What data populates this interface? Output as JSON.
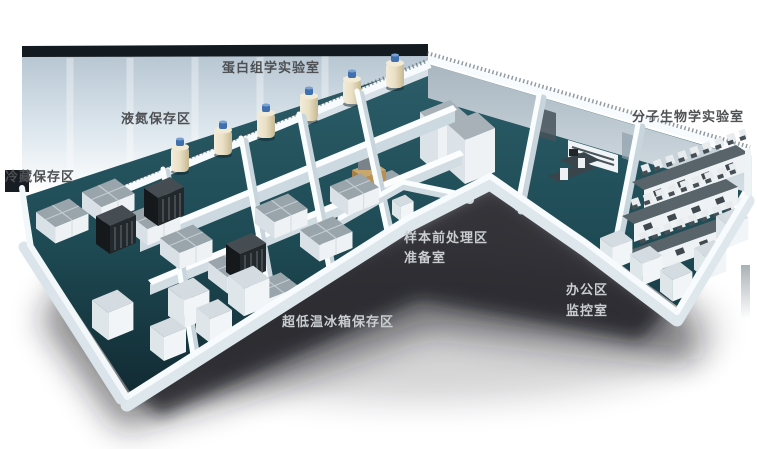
{
  "canvas": {
    "width": 757,
    "height": 449,
    "background": "#ffffff"
  },
  "labels": {
    "proteomics_lab": "蛋白组学实验室",
    "liquid_nitrogen_area": "液氮保存区",
    "cold_storage_area": "冷藏保存区",
    "molecular_biology_lab": "分子生物学实验室",
    "sample_pretreatment_area": "样本前处理区",
    "preparation_room": "准备室",
    "office_area": "办公区",
    "monitoring_room": "监控室",
    "ult_freezer_area": "超低温冰箱保存区"
  },
  "colors": {
    "label_dark": "#4e5053",
    "label_light": "#c9cdd0",
    "floor_teal": "#1e4a54",
    "floor_teal_dark": "#132d35",
    "wall_white": "#f8fbfd",
    "wall_face": "#ccd7de",
    "back_wall_top": "#b7c6d2",
    "roof_cap": "#141b20",
    "freezer_top": "#99a4ab",
    "bench_top": "#58636a",
    "dewar_body": "#e9dfc4",
    "dewar_cap": "#3f6fae",
    "shadow": "#14181b"
  },
  "icons": {
    "nitrogen-dewar": "cream cylinder with blue cap",
    "freezer-bank": "white box with gray top",
    "storage-rack": "dark slatted box",
    "white-cabinet": "white box",
    "lab-bench-row": "white counter, dark top, reagent shelf"
  }
}
